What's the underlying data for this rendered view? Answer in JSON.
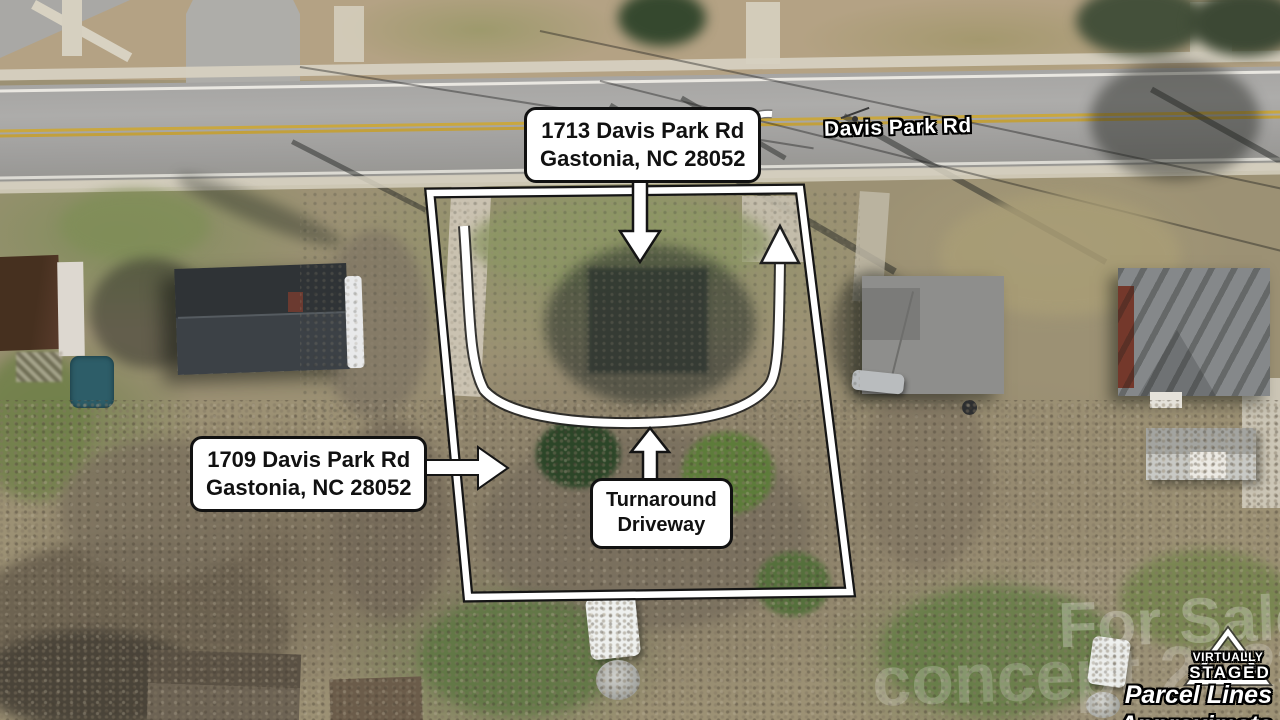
{
  "annotations": {
    "label_1713": {
      "line1": "1713 Davis Park Rd",
      "line2": "Gastonia, NC 28052"
    },
    "label_1709": {
      "line1": "1709 Davis Park Rd",
      "line2": "Gastonia, NC 28052"
    },
    "label_turnaround": {
      "line1": "Turnaround",
      "line2": "Driveway"
    },
    "road_name": "Davis Park Rd"
  },
  "badge": {
    "line1": "VIRTUALLY",
    "line2": "STAGED",
    "disclaimer_line1": "Parcel Lines",
    "disclaimer_line2": "Approximate"
  },
  "watermark": {
    "line1": "For Sale",
    "line2": "concept 2023"
  },
  "colors": {
    "annotation_white": "#ffffff",
    "annotation_outline": "#111111",
    "parcel_line_white": "#ffffff",
    "parcel_line_black": "#151515",
    "road_asphalt": "#a6a5a3",
    "center_line_yellow": "#c9a73f",
    "pool_teal": "#2d5d68"
  }
}
